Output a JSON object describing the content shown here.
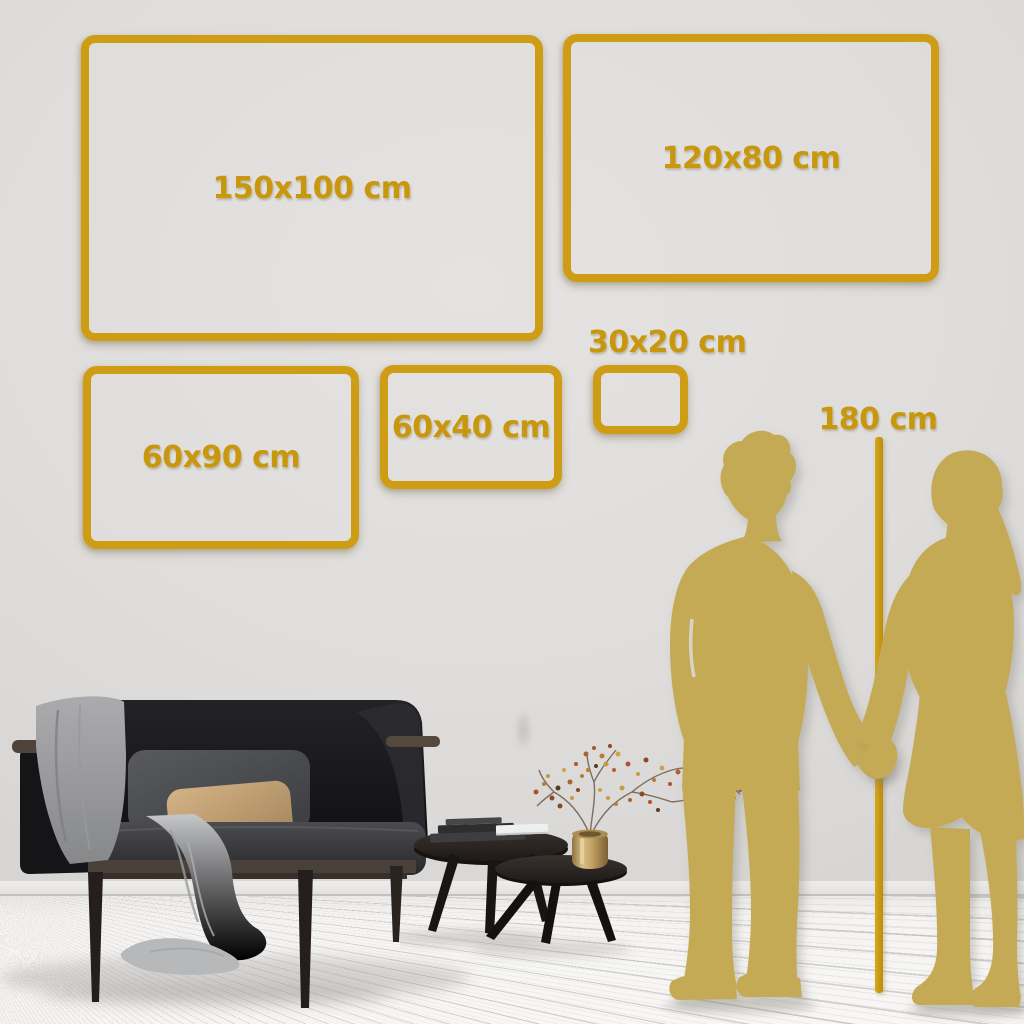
{
  "sizes": [
    {
      "label": "150x100 cm"
    },
    {
      "label": "120x80 cm"
    },
    {
      "label": "60x90 cm"
    },
    {
      "label": "60x40 cm"
    },
    {
      "label": "30x20 cm"
    }
  ],
  "measure": {
    "label": "180 cm"
  },
  "colors": {
    "accent_gold": "#CF9D15",
    "label_gold": "#C9970E",
    "silhouette_gold": "#C5AA57",
    "wall_gray": "#DFDDDB",
    "floor_white": "#F5F4F2"
  },
  "illustrations": {
    "man": "man-silhouette",
    "woman": "woman-silhouette",
    "sofa": "sofa-with-blanket",
    "tables": "coffee-tables-with-vase-and-plant"
  }
}
